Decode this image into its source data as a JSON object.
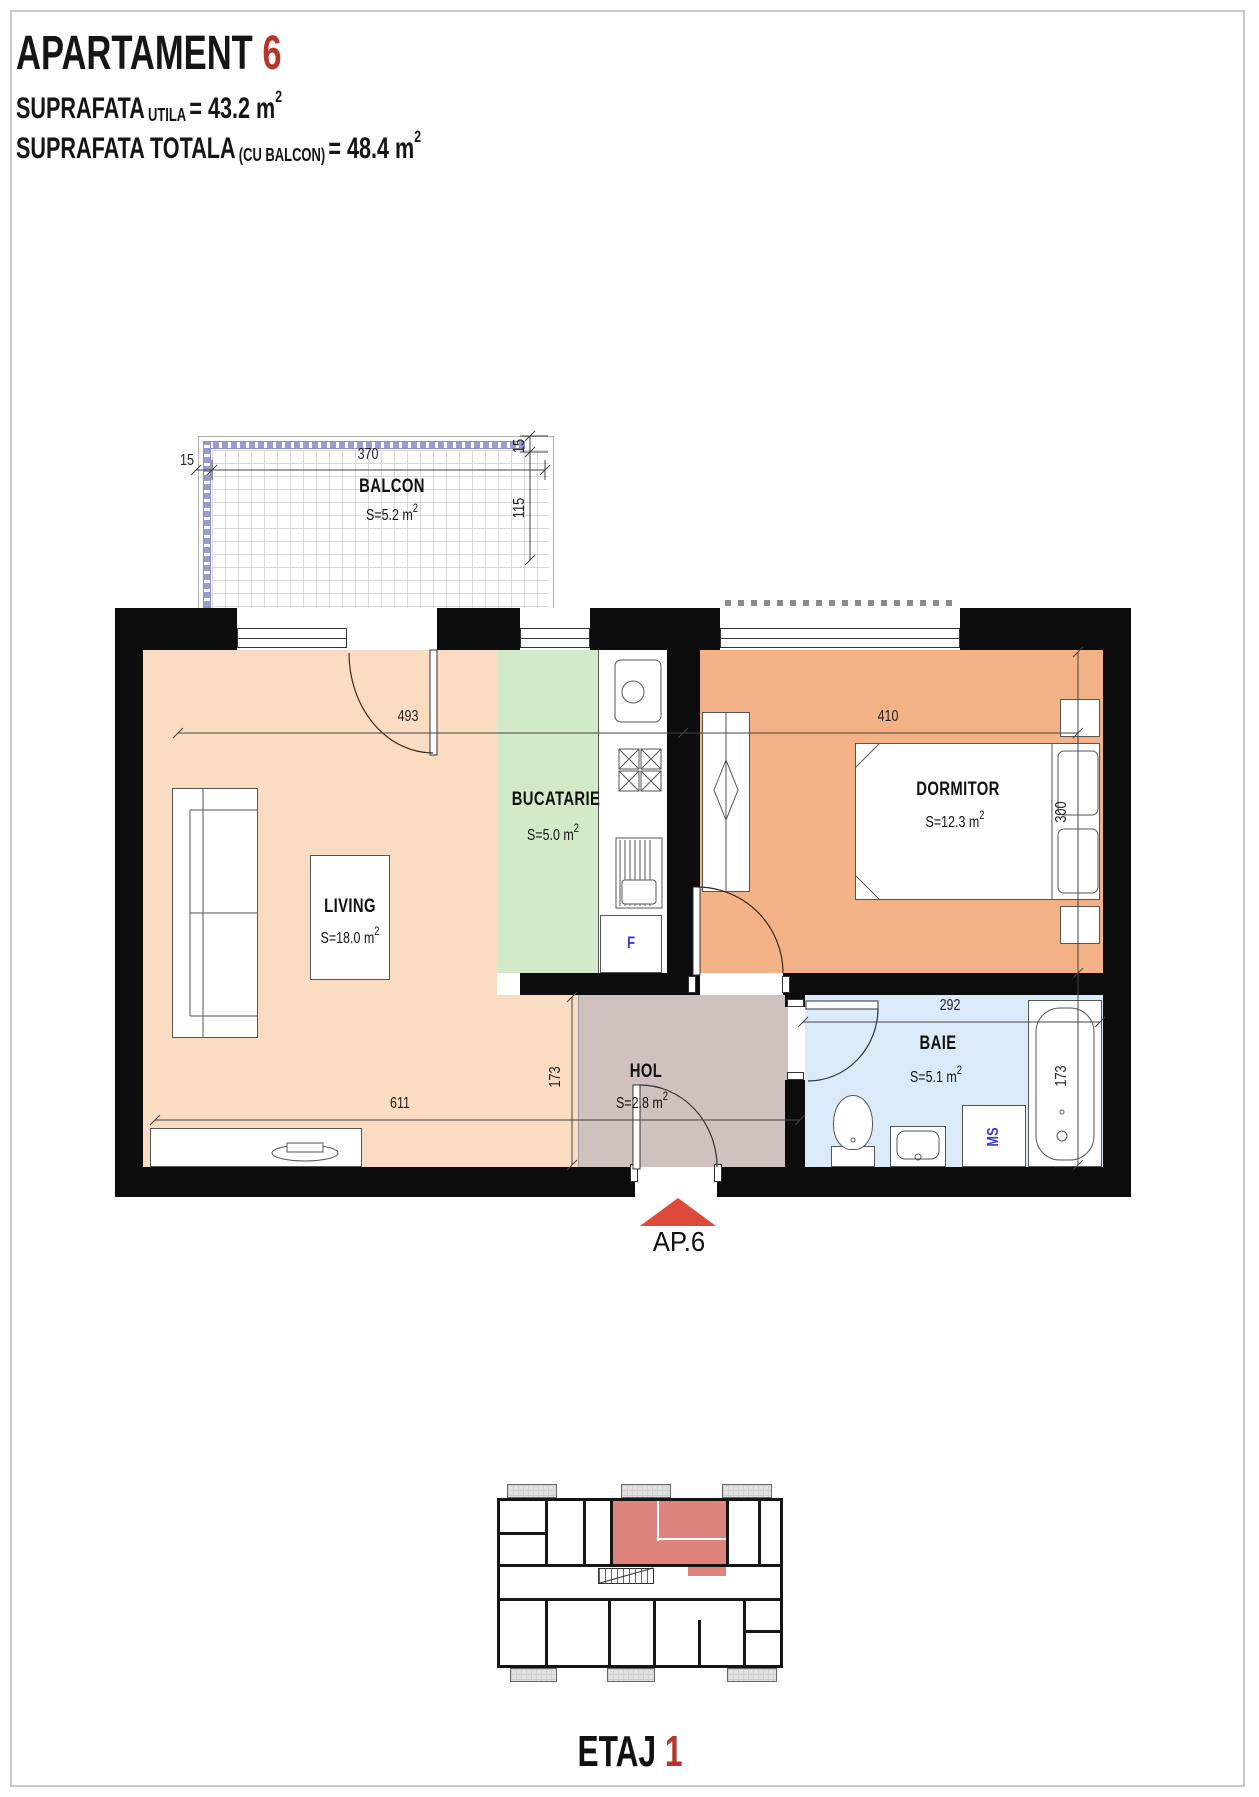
{
  "page": {
    "title": "APARTAMENT",
    "title_number": "6",
    "suprafata_utila": {
      "label": "SUPRAFATA",
      "sub": "UTILA",
      "value": "= 43.2 m",
      "sup": "2"
    },
    "suprafata_totala": {
      "label": "SUPRAFATA TOTALA",
      "sub": "(CU BALCON)",
      "value": "= 48.4 m",
      "sup": "2"
    }
  },
  "plan": {
    "rooms": {
      "balcon": {
        "name": "BALCON",
        "area_base": "S=5.2 m",
        "area_sup": "2"
      },
      "living": {
        "name": "LIVING",
        "area_base": "S=18.0 m",
        "area_sup": "2"
      },
      "bucatarie": {
        "name": "BUCATARIE",
        "area_base": "S=5.0 m",
        "area_sup": "2"
      },
      "dormitor": {
        "name": "DORMITOR",
        "area_base": "S=12.3 m",
        "area_sup": "2"
      },
      "hol": {
        "name": "HOL",
        "area_base": "S=2.8 m",
        "area_sup": "2"
      },
      "baie": {
        "name": "BAIE",
        "area_base": "S=5.1 m",
        "area_sup": "2"
      }
    },
    "dims": {
      "balcony_width": "370",
      "balcony_rail": "15",
      "balcony_side": "15",
      "balcony_depth": "115",
      "living_width": "493",
      "dormitor_width": "410",
      "dormitor_depth": "300",
      "living_total_width": "611",
      "hol_depth": "173",
      "baie_width": "292",
      "baie_depth": "173"
    },
    "appliances": {
      "fridge": "F",
      "washing_machine": "MS"
    },
    "entrance": {
      "label": "AP.6"
    }
  },
  "footer": {
    "floor": "ETAJ",
    "floor_number": "1"
  },
  "colors": {
    "accent_red": "#b5372c",
    "arrow_red": "#dd4a3c",
    "living": "#f9dcc2",
    "dormitor": "#f3b285",
    "bucatarie": "#d3eac9",
    "hol": "#cfc1be",
    "baie": "#dbeaf8",
    "highlight_unit": "#df837d",
    "railing": "#9b9bd4"
  }
}
